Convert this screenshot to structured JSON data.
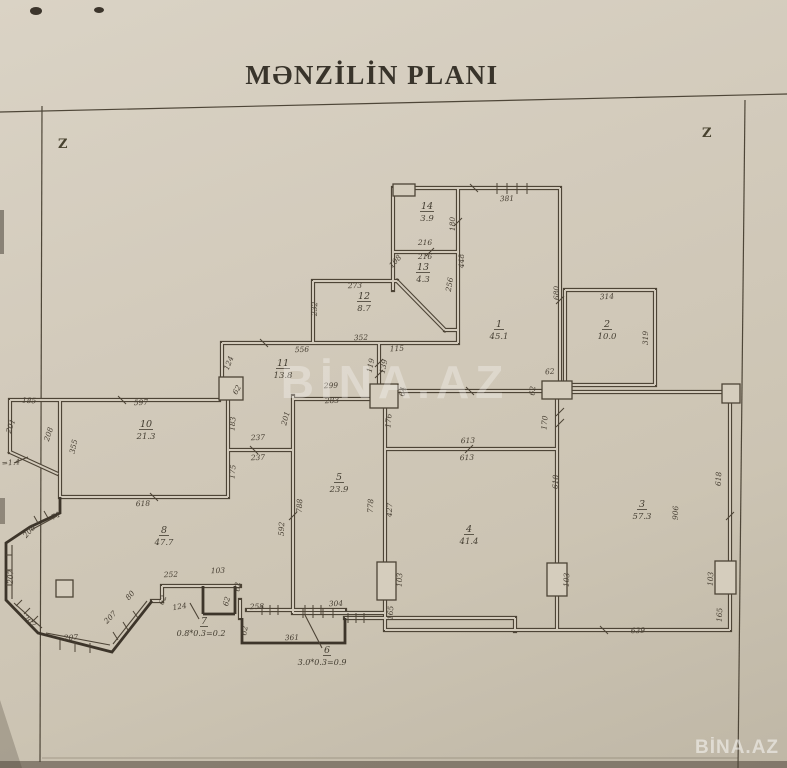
{
  "document": {
    "title": "MƏNZİLİN PLANI",
    "orientation_marks": {
      "left": "Z",
      "right": "Z"
    },
    "watermark": "BİNA.AZ"
  },
  "plan": {
    "rooms": [
      {
        "number": "14",
        "area": "3.9",
        "x": 427,
        "y": 209
      },
      {
        "number": "13",
        "area": "4.3",
        "x": 423,
        "y": 270
      },
      {
        "number": "12",
        "area": "8.7",
        "x": 364,
        "y": 299
      },
      {
        "number": "1",
        "area": "45.1",
        "x": 499,
        "y": 327
      },
      {
        "number": "2",
        "area": "10.0",
        "x": 607,
        "y": 327
      },
      {
        "number": "11",
        "area": "13.8",
        "x": 283,
        "y": 366
      },
      {
        "number": "10",
        "area": "21.3",
        "x": 146,
        "y": 427
      },
      {
        "number": "5",
        "area": "23.9",
        "x": 339,
        "y": 480
      },
      {
        "number": "4",
        "area": "41.4",
        "x": 469,
        "y": 532
      },
      {
        "number": "3",
        "area": "57.3",
        "x": 642,
        "y": 507
      },
      {
        "number": "8",
        "area": "47.7",
        "x": 164,
        "y": 533
      }
    ],
    "formula_rooms": [
      {
        "number": "7",
        "formula": "0.8*0.3=0.2",
        "x": 204,
        "y": 624,
        "fx": 201,
        "fy": 636
      },
      {
        "number": "6",
        "formula": "3.0*0.3=0.9",
        "x": 327,
        "y": 653,
        "fx": 322,
        "fy": 665
      }
    ],
    "dimensions": [
      {
        "t": "381",
        "x": 507,
        "y": 201,
        "r": -2
      },
      {
        "t": "216",
        "x": 425,
        "y": 245,
        "r": 0
      },
      {
        "t": "180",
        "x": 455,
        "y": 224,
        "r": -90
      },
      {
        "t": "216",
        "x": 425,
        "y": 259,
        "r": 0
      },
      {
        "t": "448",
        "x": 464,
        "y": 261,
        "r": -90
      },
      {
        "t": "256",
        "x": 452,
        "y": 285,
        "r": -80
      },
      {
        "t": "108",
        "x": 397,
        "y": 263,
        "r": -48
      },
      {
        "t": "273",
        "x": 355,
        "y": 288,
        "r": -2
      },
      {
        "t": "232",
        "x": 317,
        "y": 309,
        "r": -88
      },
      {
        "t": "352",
        "x": 361,
        "y": 340,
        "r": -2
      },
      {
        "t": "115",
        "x": 397,
        "y": 351,
        "r": -3
      },
      {
        "t": "119",
        "x": 373,
        "y": 366,
        "r": -78
      },
      {
        "t": "139",
        "x": 386,
        "y": 367,
        "r": -78
      },
      {
        "t": "556",
        "x": 302,
        "y": 352,
        "r": -2
      },
      {
        "t": "124",
        "x": 231,
        "y": 364,
        "r": -68
      },
      {
        "t": "680",
        "x": 559,
        "y": 293,
        "r": -90
      },
      {
        "t": "314",
        "x": 607,
        "y": 299,
        "r": -3
      },
      {
        "t": "319",
        "x": 648,
        "y": 338,
        "r": -90
      },
      {
        "t": "62",
        "x": 550,
        "y": 374,
        "r": -5
      },
      {
        "t": "62",
        "x": 535,
        "y": 391,
        "r": -85
      },
      {
        "t": "170",
        "x": 547,
        "y": 423,
        "r": -85
      },
      {
        "t": "64",
        "x": 405,
        "y": 392,
        "r": -80
      },
      {
        "t": "176",
        "x": 391,
        "y": 421,
        "r": -85
      },
      {
        "t": "299",
        "x": 331,
        "y": 388,
        "r": -2
      },
      {
        "t": "283",
        "x": 332,
        "y": 403,
        "r": -2
      },
      {
        "t": "62",
        "x": 239,
        "y": 391,
        "r": -60
      },
      {
        "t": "201",
        "x": 288,
        "y": 419,
        "r": -75
      },
      {
        "t": "183",
        "x": 235,
        "y": 424,
        "r": -85
      },
      {
        "t": "237",
        "x": 258,
        "y": 440,
        "r": -2
      },
      {
        "t": "237",
        "x": 258,
        "y": 460,
        "r": -2
      },
      {
        "t": "175",
        "x": 235,
        "y": 472,
        "r": -85
      },
      {
        "t": "597",
        "x": 141,
        "y": 405,
        "r": -2
      },
      {
        "t": "185",
        "x": 29,
        "y": 403,
        "r": 3
      },
      {
        "t": "201",
        "x": 13,
        "y": 427,
        "r": -70
      },
      {
        "t": "208",
        "x": 51,
        "y": 435,
        "r": -72
      },
      {
        "t": "355",
        "x": 76,
        "y": 447,
        "r": -78
      },
      {
        "t": "618",
        "x": 143,
        "y": 506,
        "r": -2
      },
      {
        "t": "=1.4",
        "x": 11,
        "y": 465,
        "r": -5
      },
      {
        "t": "71",
        "x": 57,
        "y": 518,
        "r": -28
      },
      {
        "t": "592",
        "x": 284,
        "y": 529,
        "r": -88
      },
      {
        "t": "788",
        "x": 302,
        "y": 506,
        "r": -88
      },
      {
        "t": "778",
        "x": 373,
        "y": 506,
        "r": -88
      },
      {
        "t": "427",
        "x": 392,
        "y": 510,
        "r": -88
      },
      {
        "t": "613",
        "x": 468,
        "y": 443,
        "r": -2
      },
      {
        "t": "613",
        "x": 467,
        "y": 460,
        "r": -2
      },
      {
        "t": "618",
        "x": 558,
        "y": 482,
        "r": -88
      },
      {
        "t": "618",
        "x": 721,
        "y": 479,
        "r": -88
      },
      {
        "t": "906",
        "x": 678,
        "y": 513,
        "r": -88
      },
      {
        "t": "103",
        "x": 402,
        "y": 580,
        "r": -88
      },
      {
        "t": "103",
        "x": 569,
        "y": 580,
        "r": -88
      },
      {
        "t": "103",
        "x": 713,
        "y": 579,
        "r": -88
      },
      {
        "t": "165",
        "x": 393,
        "y": 613,
        "r": -88
      },
      {
        "t": "165",
        "x": 722,
        "y": 615,
        "r": -88
      },
      {
        "t": "639",
        "x": 638,
        "y": 633,
        "r": -2
      },
      {
        "t": "252",
        "x": 171,
        "y": 577,
        "r": -2
      },
      {
        "t": "103",
        "x": 218,
        "y": 573,
        "r": -2
      },
      {
        "t": "62",
        "x": 240,
        "y": 587,
        "r": -85
      },
      {
        "t": "62",
        "x": 165,
        "y": 601,
        "r": -68
      },
      {
        "t": "124",
        "x": 180,
        "y": 609,
        "r": -10
      },
      {
        "t": "258",
        "x": 257,
        "y": 609,
        "r": -2
      },
      {
        "t": "304",
        "x": 336,
        "y": 606,
        "r": -2
      },
      {
        "t": "361",
        "x": 292,
        "y": 640,
        "r": -2
      },
      {
        "t": "62",
        "x": 229,
        "y": 602,
        "r": -75
      },
      {
        "t": "62",
        "x": 247,
        "y": 631,
        "r": -80
      },
      {
        "t": "207",
        "x": 112,
        "y": 619,
        "r": -46
      },
      {
        "t": "207",
        "x": 71,
        "y": 640,
        "r": -2
      },
      {
        "t": "207",
        "x": 28,
        "y": 623,
        "r": 42
      },
      {
        "t": "207",
        "x": 13,
        "y": 577,
        "r": -88
      },
      {
        "t": "208",
        "x": 31,
        "y": 533,
        "r": -48
      },
      {
        "t": "80",
        "x": 132,
        "y": 597,
        "r": -50
      }
    ]
  }
}
